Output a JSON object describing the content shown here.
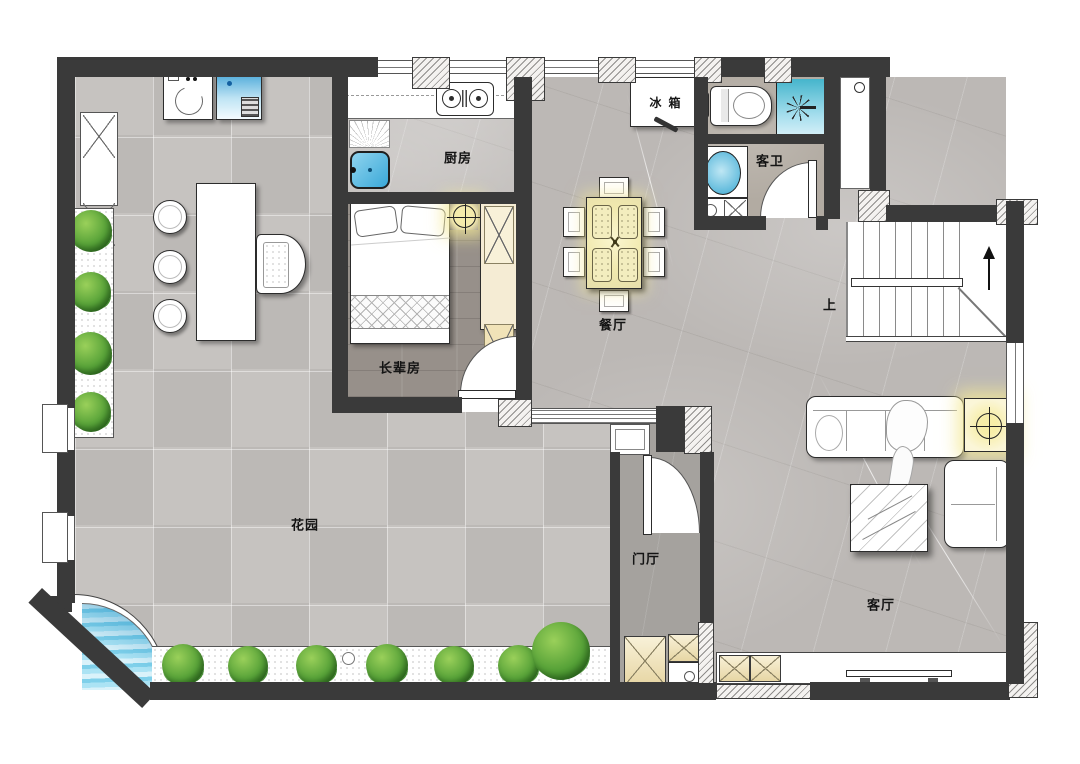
{
  "floorplan": {
    "rooms": {
      "garden": {
        "label": "花园"
      },
      "kitchen": {
        "label": "厨房"
      },
      "elder_room": {
        "label": "长辈房"
      },
      "dining": {
        "label": "餐厅"
      },
      "guest_bath": {
        "label": "客卫"
      },
      "foyer": {
        "label": "门厅"
      },
      "living": {
        "label": "客厅"
      }
    },
    "annotations": {
      "fridge": "冰箱",
      "stairs_up": "上"
    },
    "colors": {
      "wall": "#3a3a3a",
      "garden_tile": "#c6c3c0",
      "marble": "#bcb8b5",
      "wood_floor": "#97908a",
      "bath_floor": "#b2aba2",
      "foyer_floor": "#a5a29e",
      "glow_yellow": "#f5eba8",
      "water_blue": "#5cc3e2",
      "shower_teal": "#45b5cc",
      "plant_green": "#4f9e35",
      "cabinet_tan": "#f2e6c2"
    }
  }
}
